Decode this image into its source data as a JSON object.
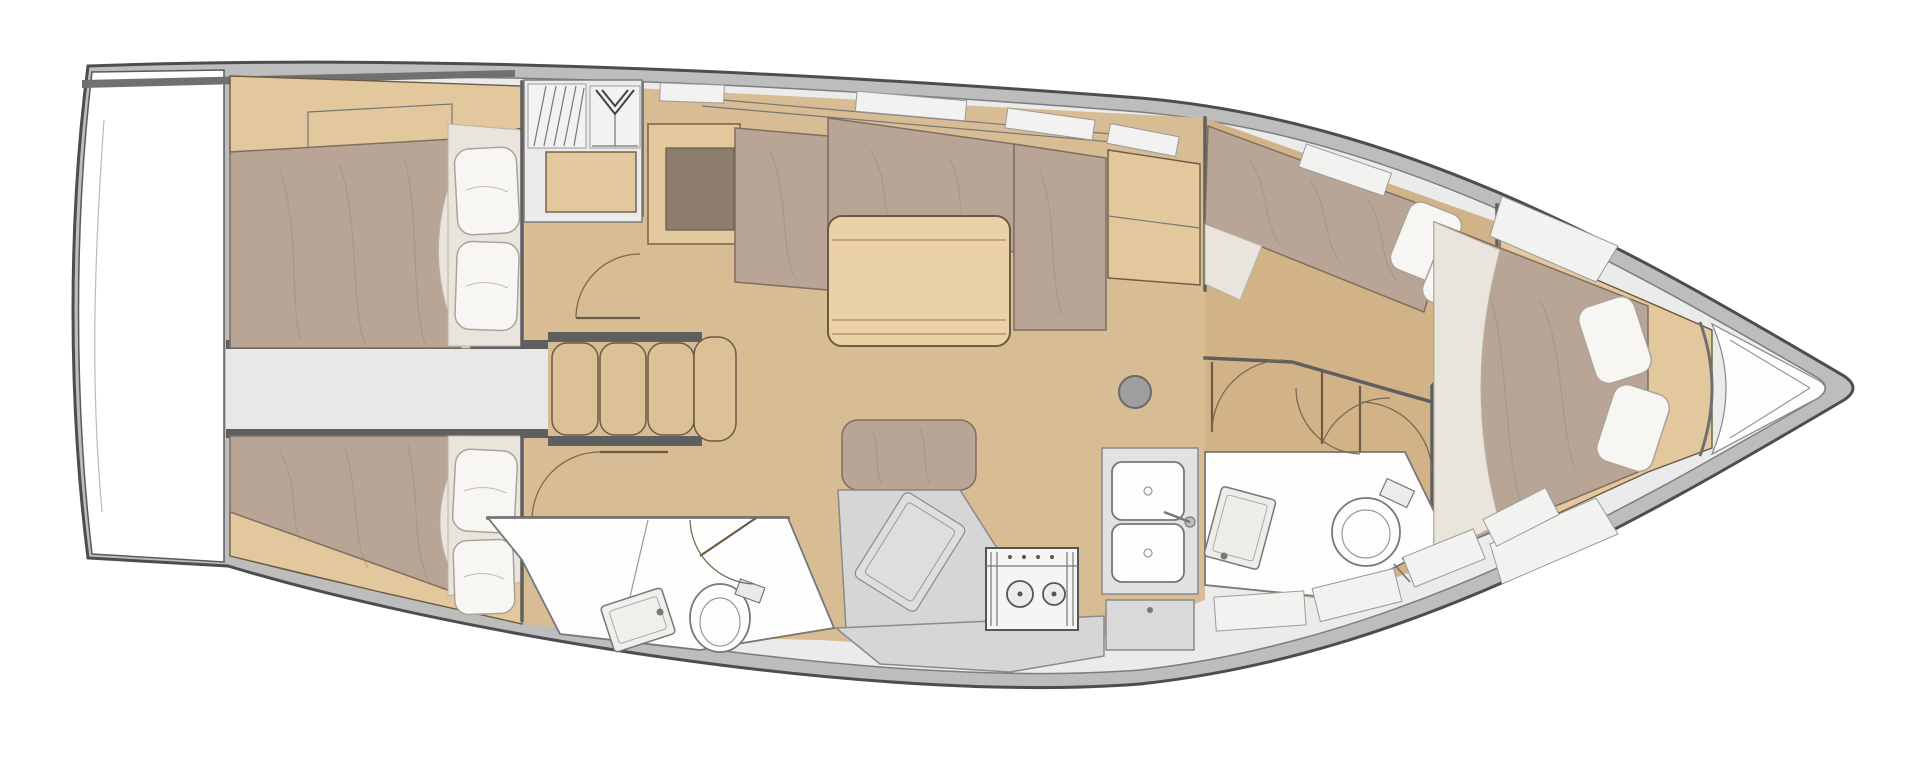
{
  "meta": {
    "title": "Sailing yacht interior layout floor plan (top view)",
    "diagram_type": "floorplan",
    "orientation": "bow-right-stern-left",
    "visible_text": []
  },
  "palette": {
    "bg": "#ffffff",
    "white": "#ffffff",
    "hullRim": "#bdbdbd",
    "hullStroke": "#4d4d4d",
    "deck": "#ebebeb",
    "deckStroke": "#7d7d7d",
    "floorWood": "#d7bc94",
    "floorWoodFwd": "#d2b388",
    "furnitureWood": "#e3c89e",
    "tableWood": "#ead2a6",
    "stairWood": "#dcc197",
    "woodStroke": "#6b5b43",
    "mattress": "#b8a595",
    "mattressStroke": "#7e6f61",
    "sheet": "#eae5dc",
    "pillow": "#f7f6f2",
    "pillowStroke": "#a9a49b",
    "counter": "#d6d6d6",
    "counterStroke": "#8a8a8a",
    "fixtureWhite": "#fdfdfd",
    "fixtureStroke": "#777777",
    "wall": "#5f5f5f",
    "mast": "#9e9e9e",
    "darkInset": "#8d7d6e",
    "panel": "#f2f2f0"
  },
  "components": {
    "rooms": [
      "transom-platform",
      "aft-cabin-port",
      "aft-cabin-starboard",
      "engine-compartment",
      "aft-head-bathroom",
      "saloon",
      "galley",
      "forward-head-bathroom",
      "forward-cabin-port",
      "bow-cabin",
      "anchor-locker"
    ],
    "furniture": [
      "double-bed",
      "pillows",
      "settee-l-shaped",
      "saloon-table",
      "bench-seat",
      "fridge-module",
      "companionway-stairs",
      "hanging-locker",
      "louvered-locker",
      "stove-two-burner",
      "double-sink",
      "wash-basin",
      "toilet",
      "chart-cabinet",
      "mast-post",
      "door-swing"
    ]
  },
  "icons": [
    "hanger-icon",
    "stove-burner-icon",
    "sink-basin-icon",
    "toilet-icon",
    "mast-icon",
    "door-swing-icon",
    "companionway-stairs-icon"
  ]
}
